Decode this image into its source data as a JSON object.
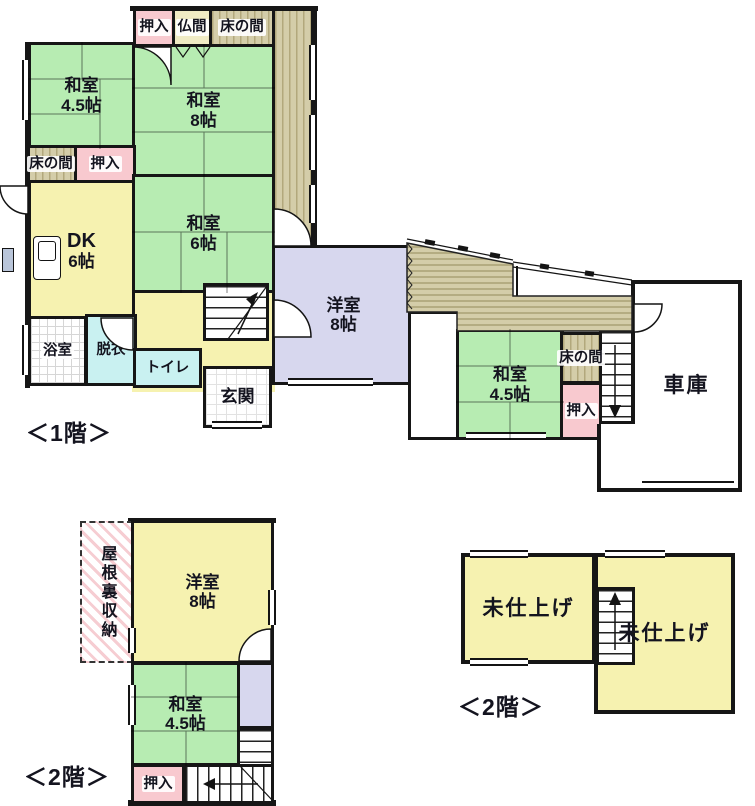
{
  "floor1": {
    "caption": "＜1階＞",
    "rooms": {
      "oshiire_top": {
        "label": "押入"
      },
      "butsuma": {
        "label": "仏間"
      },
      "tokonoma_top": {
        "label": "床の間"
      },
      "washitsu45_nw": {
        "name": "和室",
        "size": "4.5帖"
      },
      "washitsu8": {
        "name": "和室",
        "size": "8帖"
      },
      "tokonoma_w": {
        "label": "床の間"
      },
      "oshiire_w": {
        "label": "押入"
      },
      "dk": {
        "name": "DK",
        "size": "6帖"
      },
      "washitsu6": {
        "name": "和室",
        "size": "6帖"
      },
      "yoshitsu8": {
        "name": "洋室",
        "size": "8帖"
      },
      "yokushitsu": {
        "label": "浴室"
      },
      "datsui": {
        "label": "脱衣"
      },
      "toire": {
        "label": "トイレ"
      },
      "genkan": {
        "label": "玄関"
      },
      "washitsu45_e": {
        "name": "和室",
        "size": "4.5帖"
      },
      "tokonoma_e": {
        "label": "床の間"
      },
      "oshiire_e": {
        "label": "押入"
      },
      "garage": {
        "label": "車庫"
      }
    }
  },
  "floor2": {
    "caption_left": "＜2階＞",
    "caption_right": "＜2階＞",
    "rooms": {
      "yaneura": {
        "label": "屋根裏収納"
      },
      "yoshitsu8_2f": {
        "name": "洋室",
        "size": "8帖"
      },
      "washitsu45_2f": {
        "name": "和室",
        "size": "4.5帖"
      },
      "oshiire_2f": {
        "label": "押入"
      },
      "unfinished_left": {
        "label": "未仕上げ"
      },
      "unfinished_right": {
        "label": "未仕上げ"
      }
    }
  },
  "colors": {
    "tatami_green": "#b7ecb2",
    "room_yellow": "#f6f2b0",
    "western_lavender": "#d7d7ee",
    "closet_pink": "#f8c9cf",
    "butsuma_cream": "#f0ebc4",
    "wood_tan": "#d4cda9",
    "water_cyan": "#c9f1f1",
    "wall_black": "#161616"
  }
}
